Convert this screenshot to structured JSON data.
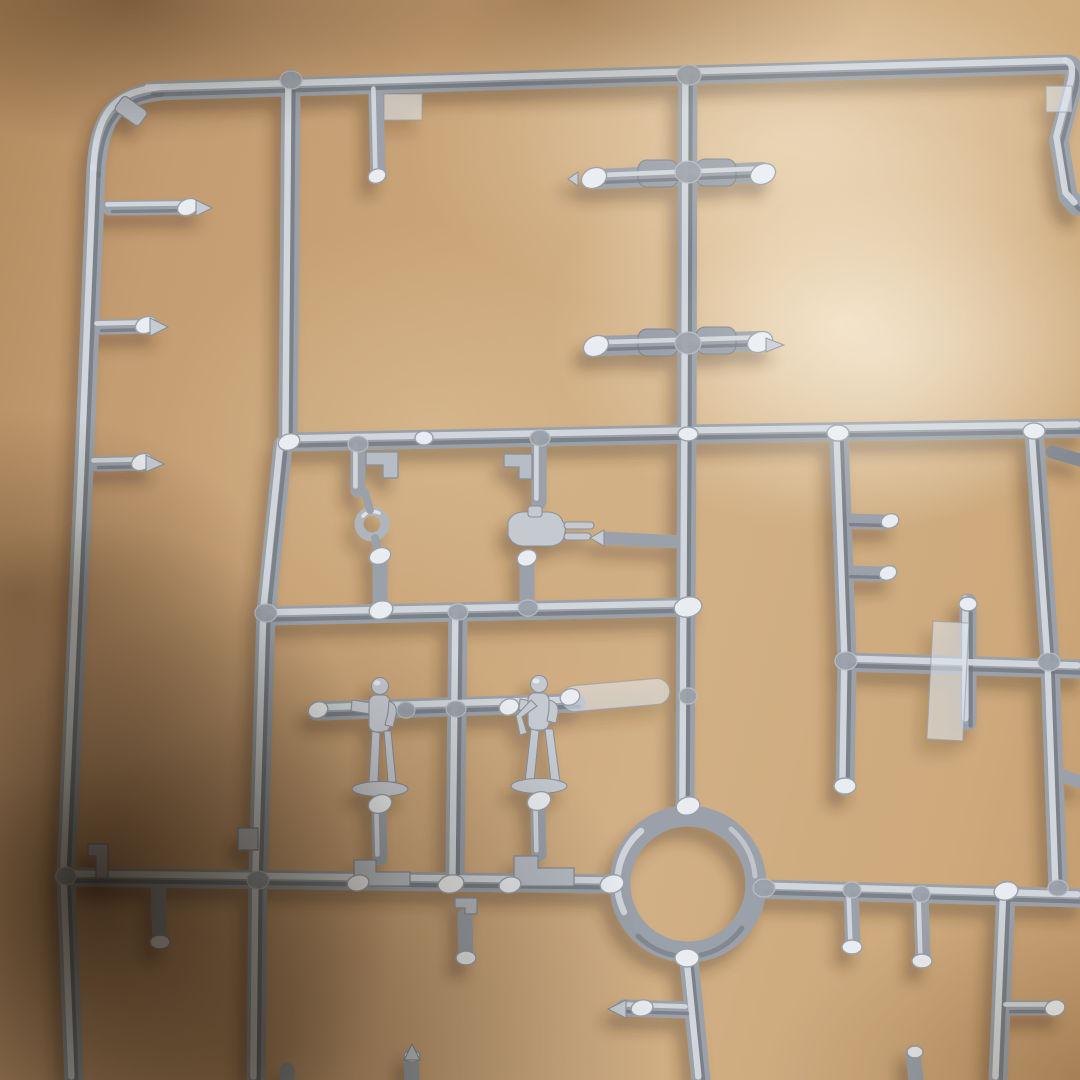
{
  "scene": {
    "description": "Close-up photo of a silver-grey injection-molded model kit sprue (parts runner) with two small standing crew figures, a circular ring part, molded pegs, clear tabs and a twin machine-gun part, lying on a tan surface with soft blurred shadows",
    "colors": {
      "surface": "#c7a076",
      "surface-light": "#ecd9b6",
      "surface-dark": "#2f2212",
      "plastic-base": "#9aa1aa",
      "plastic-hi": "#d6dbe0",
      "plastic-sh": "#6e747d",
      "plastic-gate": "#e9edf1",
      "plastic-flat": "#b7bdc5",
      "translucent": "rgba(224,231,238,0.55)",
      "fig-fill": "#c5cad1",
      "fig-line": "#8a9099"
    },
    "parts": {
      "frame": "sprue frame runners",
      "ring": "circular ring part",
      "figure_left": "standing crew figure (left)",
      "figure_right": "standing crew figure (right)",
      "gun": "twin machine-gun part",
      "eyelet": "small eyelet ring part",
      "clear_strip": "translucent strip part",
      "clear_cross": "translucent cross part",
      "stubs": "molded pegs and sprue gate stubs"
    }
  }
}
